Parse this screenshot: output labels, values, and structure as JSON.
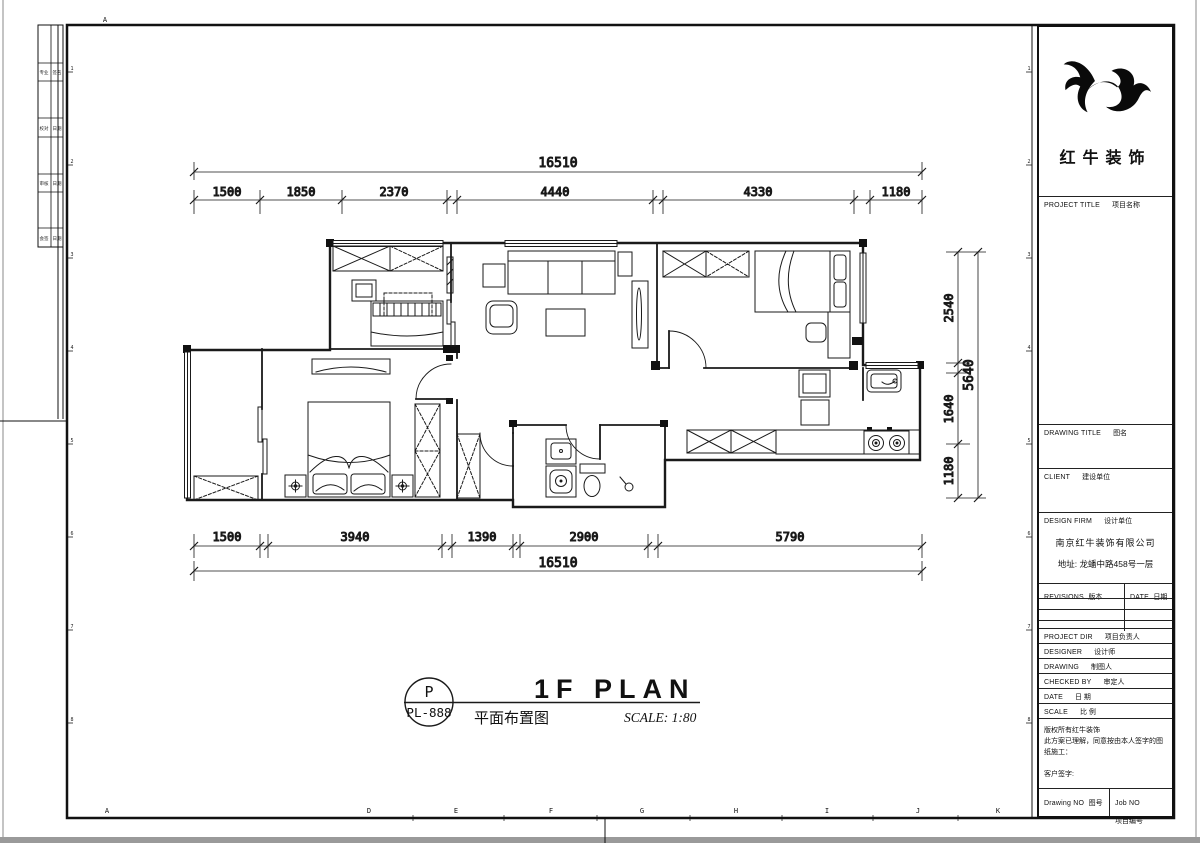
{
  "drawing": {
    "dims": {
      "top": {
        "total": "16510",
        "segments": [
          "1500",
          "1850",
          "2370",
          "4440",
          "4330",
          "1180"
        ]
      },
      "bottom": {
        "total": "16510",
        "segments": [
          "1500",
          "3940",
          "1390",
          "2900",
          "5790"
        ]
      },
      "right": {
        "total": "5640",
        "segments": [
          "2540",
          "1640",
          "1180"
        ]
      }
    },
    "stamp": {
      "bubble_letter": "P",
      "bubble_code": "PL-888",
      "title_en": "1F PLAN",
      "title_cn": "平面布置图",
      "scale_text": "SCALE: 1:80"
    }
  },
  "frame": {
    "top_letter": "A",
    "bottom_letters": [
      "A",
      "D",
      "E",
      "F",
      "G",
      "H",
      "I",
      "J",
      "K"
    ],
    "left_numbers": [
      "1",
      "2",
      "3",
      "4",
      "5",
      "6",
      "7",
      "8"
    ],
    "right_numbers": [
      "1",
      "2",
      "3",
      "4",
      "5",
      "6",
      "7",
      "8"
    ],
    "strip_rows": [
      {
        "l": "专业",
        "r": "签名"
      },
      {
        "l": "校对",
        "r": "日期"
      },
      {
        "l": "审核",
        "r": "日期"
      },
      {
        "l": "会签",
        "r": "日期"
      }
    ]
  },
  "title_block": {
    "company_name": "红牛装饰",
    "project_title_en": "PROJECT TITLE",
    "project_title_cn": "项目名称",
    "drawing_title_en": "DRAWING TITLE",
    "drawing_title_cn": "图名",
    "client_en": "CLIENT",
    "client_cn": "建设单位",
    "design_firm_en": "DESIGN FIRM",
    "design_firm_cn": "设计单位",
    "firm_name": "南京红牛装饰有限公司",
    "firm_address": "地址: 龙蟠中路458号一层",
    "revisions_en": "REVISIONS",
    "revisions_cn": "版本",
    "rev_date_en": "DATE",
    "rev_date_cn": "日期",
    "project_dir_en": "PROJECT DIR",
    "project_dir_cn": "项目负责人",
    "designer_en": "DESIGNER",
    "designer_cn": "设计师",
    "drawing_by_en": "DRAWING",
    "drawing_by_cn": "制图人",
    "checked_by_en": "CHECKED BY",
    "checked_by_cn": "审定人",
    "date_en": "DATE",
    "date_cn": "日 期",
    "scale_en": "SCALE",
    "scale_cn": "比 例",
    "statement_1": "版权所有红牛装饰",
    "statement_2": "此方案已理解，同意按由本人签字的图纸施工：",
    "statement_3": "客户签字:",
    "drawing_no_en": "Drawing NO",
    "drawing_no_cn": "图号",
    "job_no_en": "Job NO",
    "job_no_cn": "项目编号"
  }
}
